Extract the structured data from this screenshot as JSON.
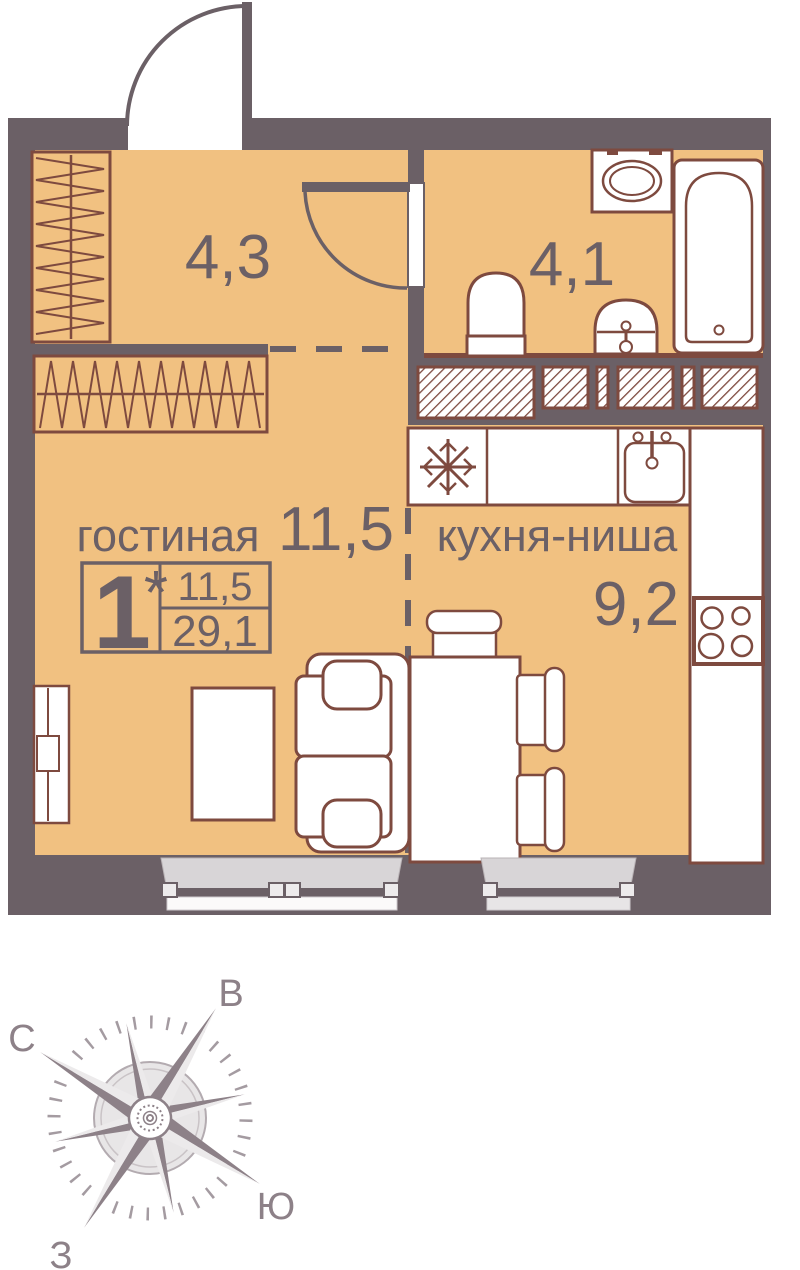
{
  "labels": {
    "hallway_area": "4,3",
    "bathroom_area": "4,1",
    "living_room_name": "гостиная",
    "living_room_area": "11,5",
    "kitchen_name": "кухня-ниша",
    "kitchen_area": "9,2"
  },
  "stamp": {
    "room_count": "1",
    "asterisk": "*",
    "living_area": "11,5",
    "total_area": "29,1"
  },
  "compass": {
    "north_label": "С",
    "east_label": "В",
    "south_label": "Ю",
    "west_label": "З"
  },
  "colors": {
    "floor": "#F1C181",
    "wall": "#6B6066",
    "furniture_outline": "#7E4A3F",
    "text": "#6B6066",
    "window_sill": "#D8D5D7",
    "window_sill_light": "#EDEBEC",
    "compass": "#8D8188",
    "compass_light": "#ECEAEB"
  },
  "icons": {
    "fridge": "snowflake-icon",
    "stove": "four-burner-stove-icon",
    "kitchen_sink": "sink-basin-icon",
    "bath_sink": "washbasin-icon",
    "toilet": "toilet-icon",
    "bathtub": "bathtub-icon",
    "washing_machine": "washing-machine-icon",
    "wardrobe": "hanger-rail-icon",
    "compass": "wind-rose-icon"
  }
}
